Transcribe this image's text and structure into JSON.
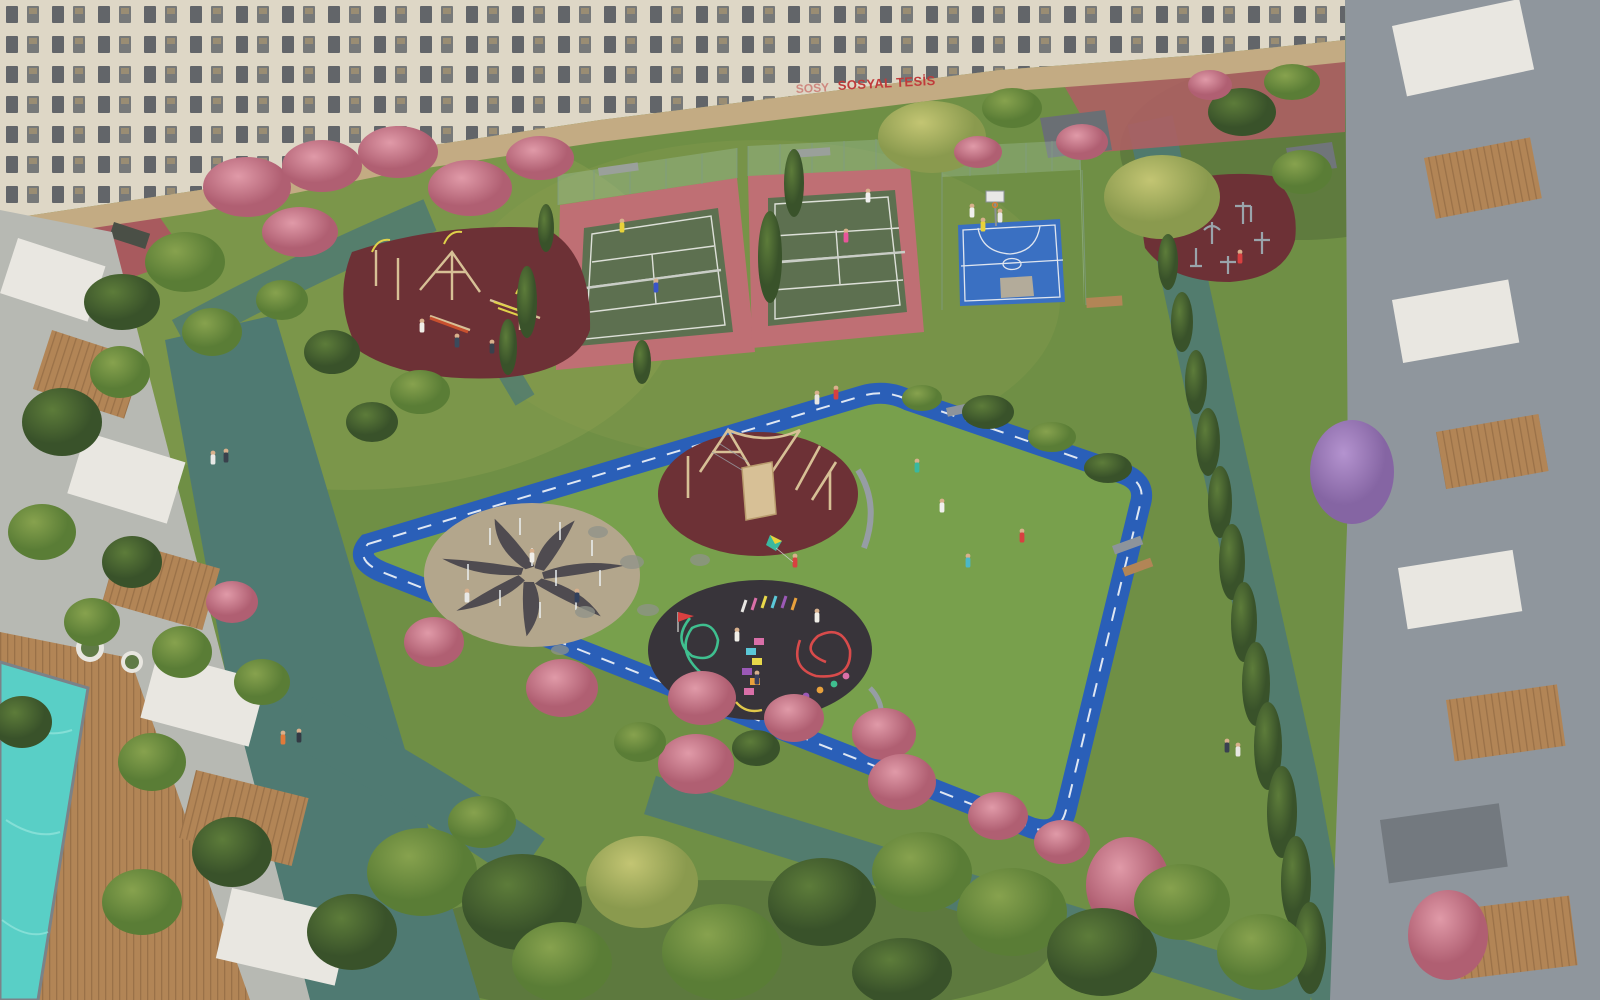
{
  "scene": {
    "description": "Aerial 3D architectural rendering of a residential complex courtyard with tennis courts, basketball court, outdoor fitness area, children's playgrounds, splash pad, colorful games pad, blue jogging track, swimming pool and landscaped gardens surrounded by apartment buildings"
  },
  "sign": {
    "text": "SOSYAL TESİS",
    "text_partial": "SOSY"
  },
  "colors": {
    "grass": "#6f8f45",
    "grass_light": "#8aa050",
    "grass_shade": "#3c5030",
    "lawn": "#78a04c",
    "track": "#2a5fb8",
    "track_line": "#e9eef5",
    "path": "#4f7a72",
    "court_green": "#5d7050",
    "court_apron": "#bf6f74",
    "court_line": "#e4e6e0",
    "basket": "#3a70c2",
    "basket_key": "#b3ab9a",
    "rubber": "#6d3136",
    "pad_dark": "#38343a",
    "paving": "#b3a68c",
    "pinwheel": "#45424a",
    "facade": "#ded7c6",
    "stone": "#c3ab83",
    "window": "#4c5158",
    "roof_white": "#e9e7e1",
    "roof_gray": "#8f969d",
    "wood": "#b28556",
    "wood_dark": "#9a7148",
    "pool": "#59cfc6",
    "fence": "#a8c7ad",
    "tree": "#6b8f3f",
    "tree_dark": "#46622e",
    "tree_light": "#93ad52",
    "willow": "#a4b060",
    "pink": "#d27f93",
    "purple": "#9b7bb5",
    "sign_red": "#c03b3b",
    "equip": "#9aa4ab",
    "bench": "#8d949b",
    "red_court": "#a85a5e",
    "red_path": "#ad5f63",
    "wood_play": "#d7c096"
  }
}
